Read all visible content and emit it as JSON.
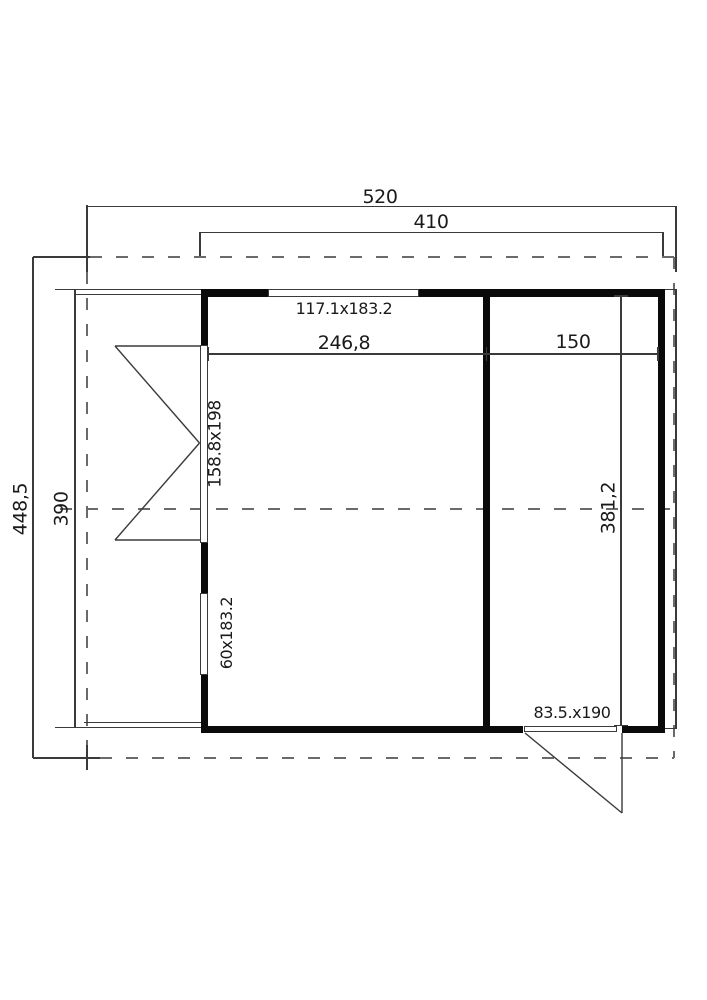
{
  "dimensions": {
    "overall_width": "520",
    "wall_width": "410",
    "overall_depth": "448,5",
    "wall_depth": "390",
    "main_room_width": "246,8",
    "side_room_width": "150",
    "interior_depth": "381,2"
  },
  "openings": {
    "front_window": "117.1x183.2",
    "french_door": "158.8x198",
    "narrow_window": "60x183.2",
    "side_door": "83.5.x190"
  },
  "colors": {
    "wall": "#0a0a0a",
    "thin_line": "#3a3a3a",
    "dashed_line": "#6a6a6a",
    "text": "#1a1a1a",
    "background": "#ffffff"
  }
}
